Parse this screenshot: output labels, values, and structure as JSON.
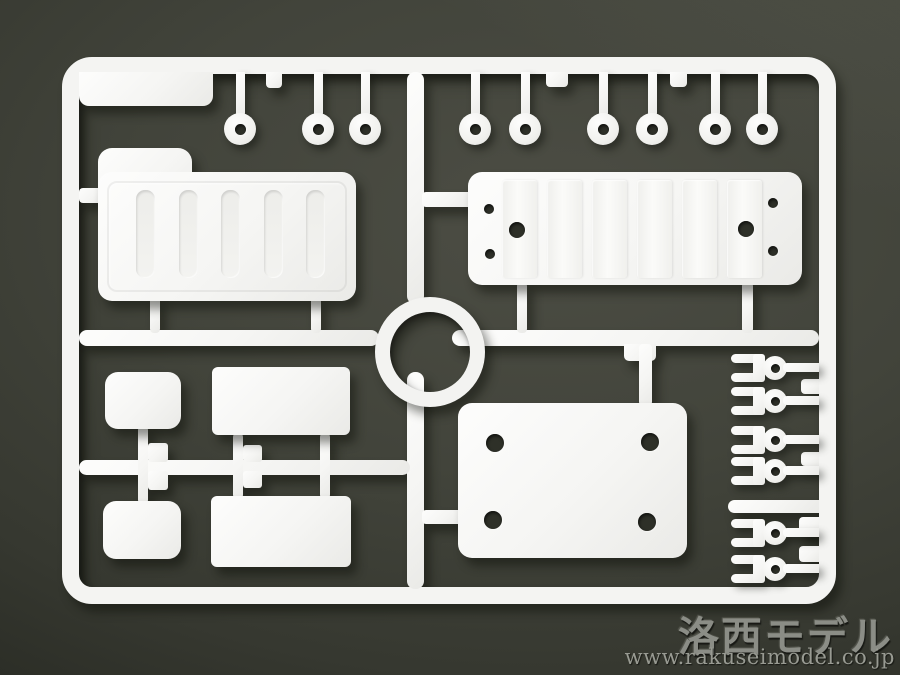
{
  "meta": {
    "description": "Photograph of an injection-molded white plastic model-kit parts sprue (runner frame) lying on a dark gray-olive background",
    "background_color": "#3c3e36",
    "plastic_color": "#f4f4f2"
  },
  "watermark": {
    "logo": "洛西モデル",
    "url": "www.rakuseimodel.co.jp",
    "text_color": "#90928c"
  },
  "sprue": {
    "frame": "rounded rectangular runner frame with center ring junction",
    "center_ring": true,
    "washers": {
      "count": 9,
      "y_center": 129,
      "x_centers": [
        240,
        318,
        365,
        475,
        525,
        603,
        652,
        715,
        762
      ]
    },
    "fork_clips": {
      "count": 6,
      "x_left": 731,
      "y_centers": [
        368,
        401,
        440,
        471,
        533,
        569
      ]
    },
    "large_parts": [
      "ribbed tray with stepped corner (upper left)",
      "long ribbed panel with mounting holes (upper right)",
      "flat base plate with four holes (lower right)",
      "upper rectangular plate (lower-left group)",
      "lower rectangular plate (lower-left group)",
      "upper rounded pad (lower-left group)",
      "lower rounded pad (lower-left group)"
    ]
  }
}
